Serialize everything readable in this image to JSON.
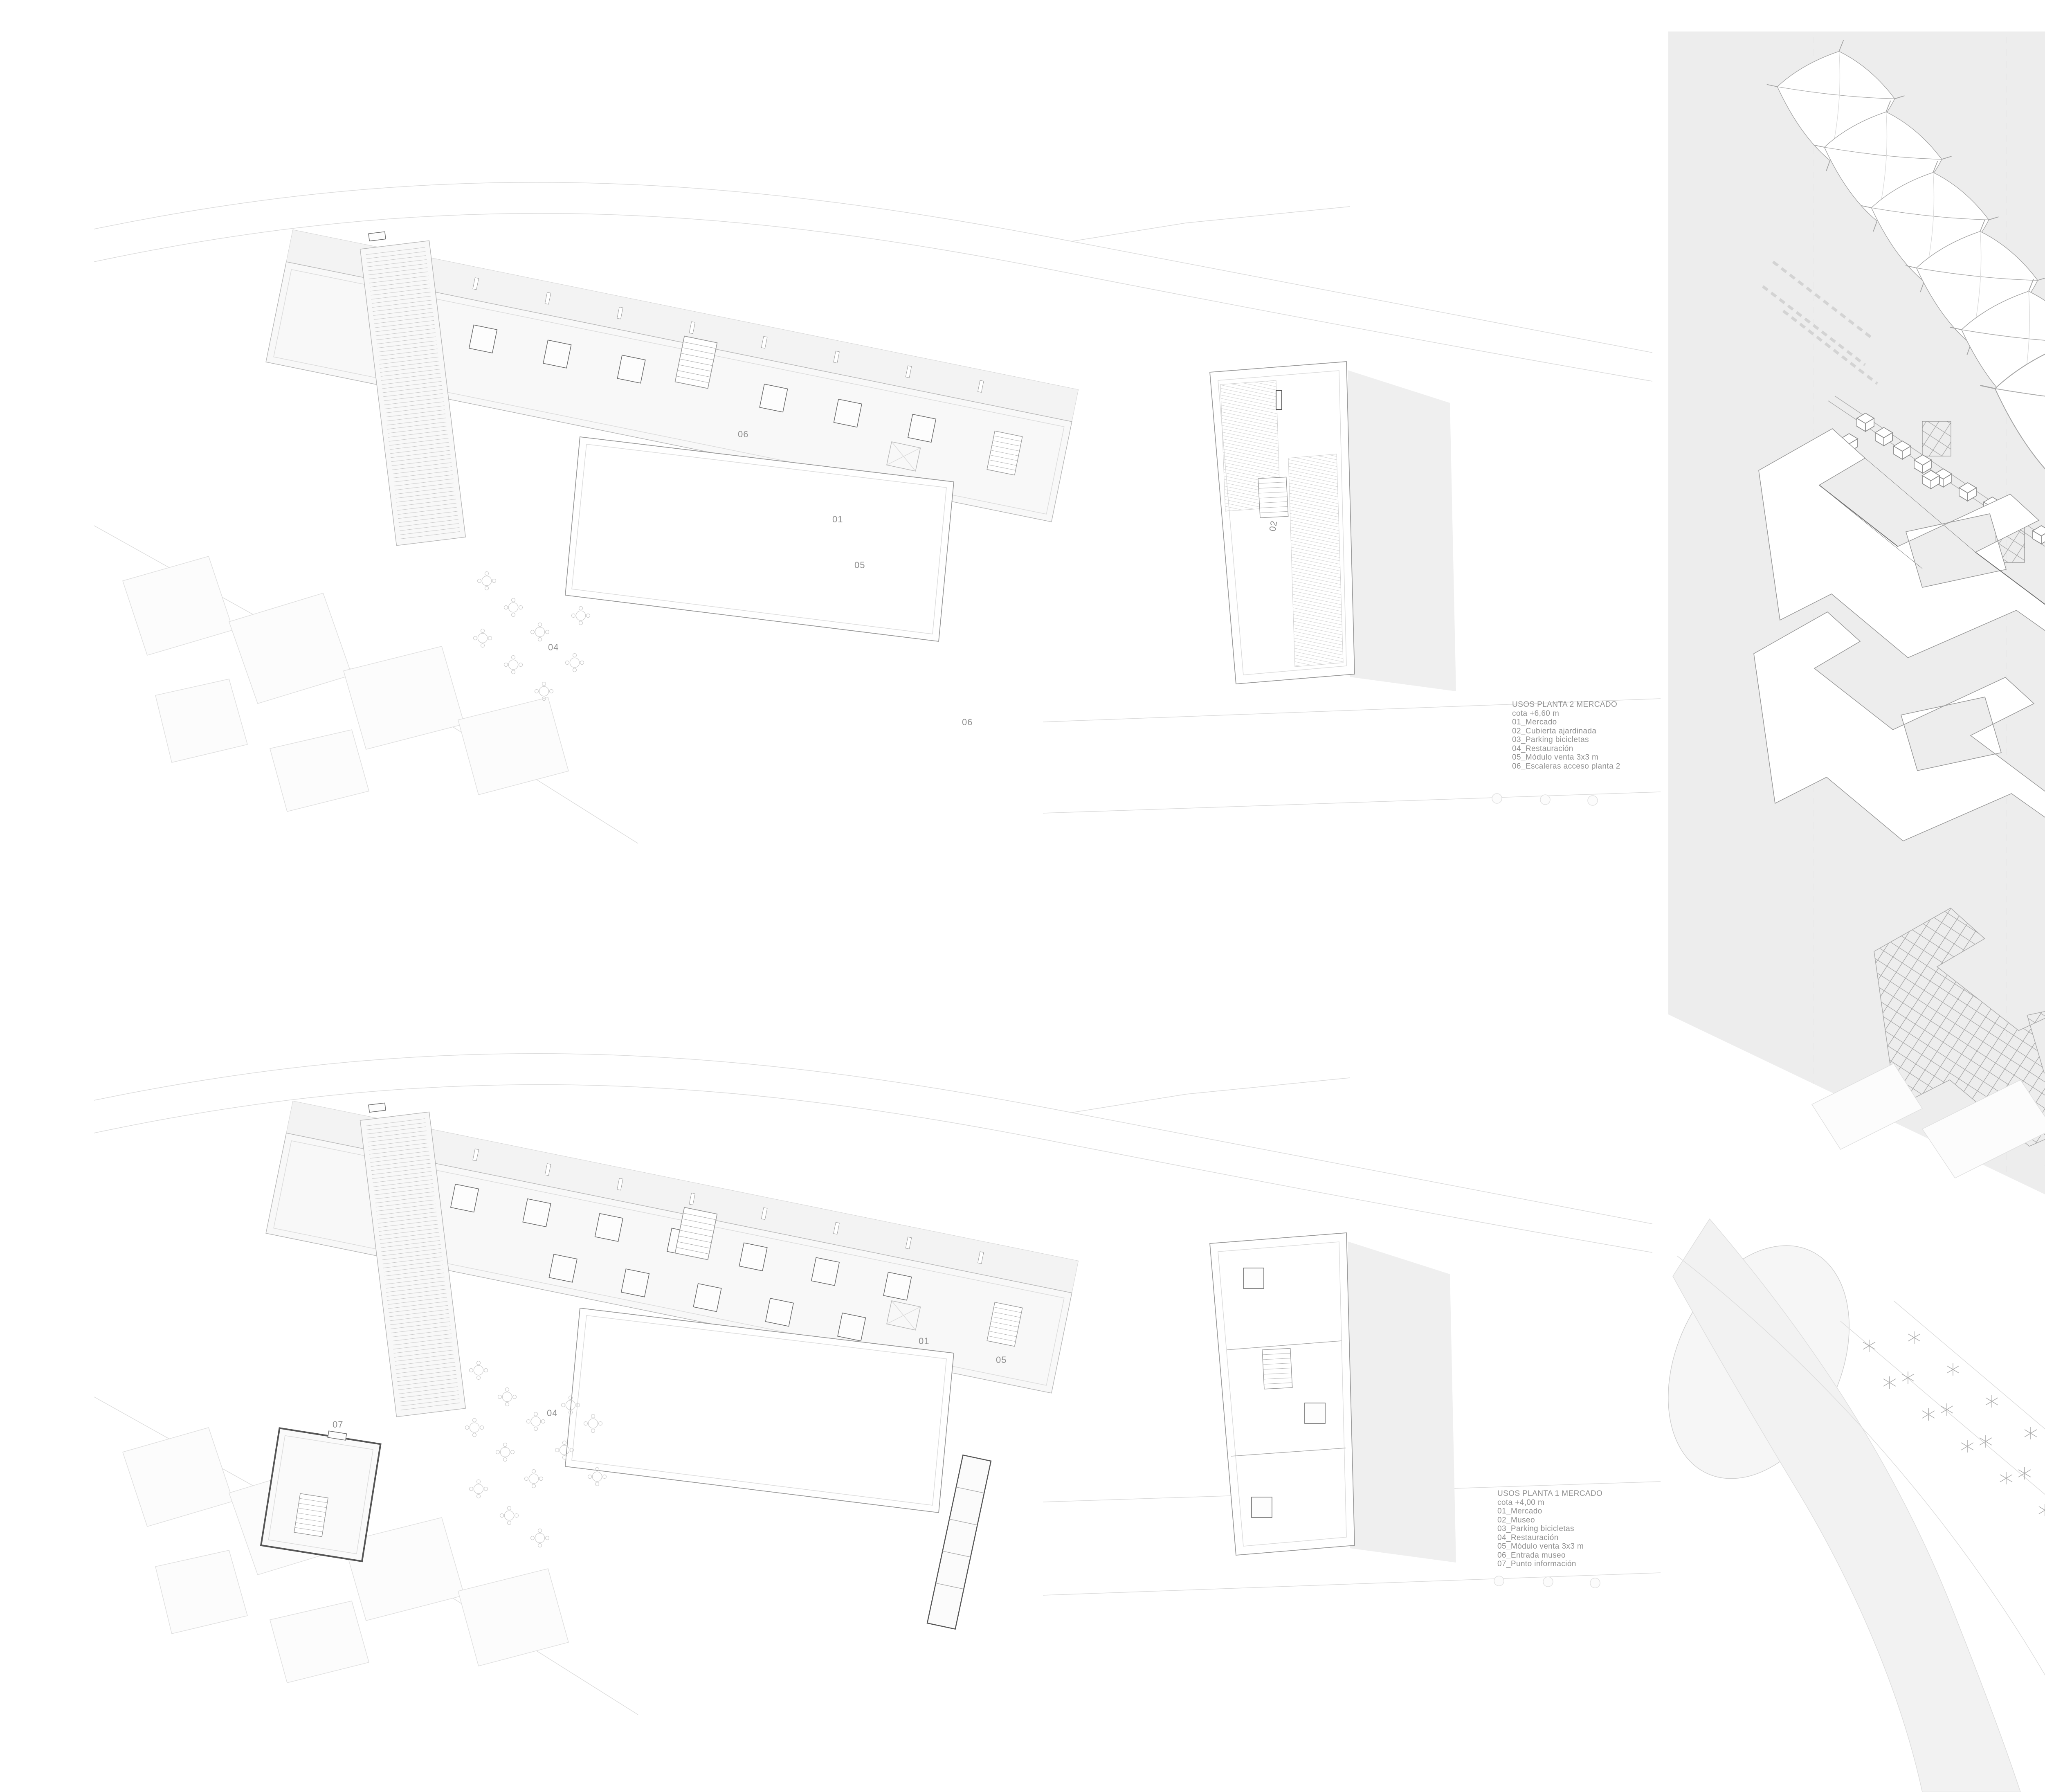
{
  "colors": {
    "paper": "#ffffff",
    "panel_bg": "#ededed",
    "line_light": "#dcdcdc",
    "line_mid": "#adadad",
    "line_dark": "#6f6f6f",
    "text_gray": "#8f8f8f"
  },
  "plan_top": {
    "legend": {
      "title": "USOS PLANTA 2 MERCADO",
      "cota": "cota +6,60 m",
      "items": [
        "01_Mercado",
        "02_Cubierta ajardinada",
        "03_Parking bicicletas",
        "04_Restauración",
        "05_Módulo venta 3x3 m",
        "06_Escaleras acceso planta 2"
      ]
    },
    "marks": [
      "06",
      "01",
      "05",
      "04",
      "06",
      "02"
    ]
  },
  "plan_bottom": {
    "legend": {
      "title": "USOS PLANTA 1 MERCADO",
      "cota": "cota +4,00 m",
      "items": [
        "01_Mercado",
        "02_Museo",
        "03_Parking bicicletas",
        "04_Restauración",
        "05_Módulo venta 3x3 m",
        "06_Entrada museo",
        "07_Punto información"
      ]
    },
    "marks": [
      "04",
      "01",
      "05",
      "07"
    ]
  },
  "axon": {
    "labels": [
      "Cubiertas monocapa",
      "Módulos mercado y museo",
      "Barandillas metálicas y pavimento madera",
      "Losa hormigón",
      "Entramado de vigas de madera"
    ]
  }
}
